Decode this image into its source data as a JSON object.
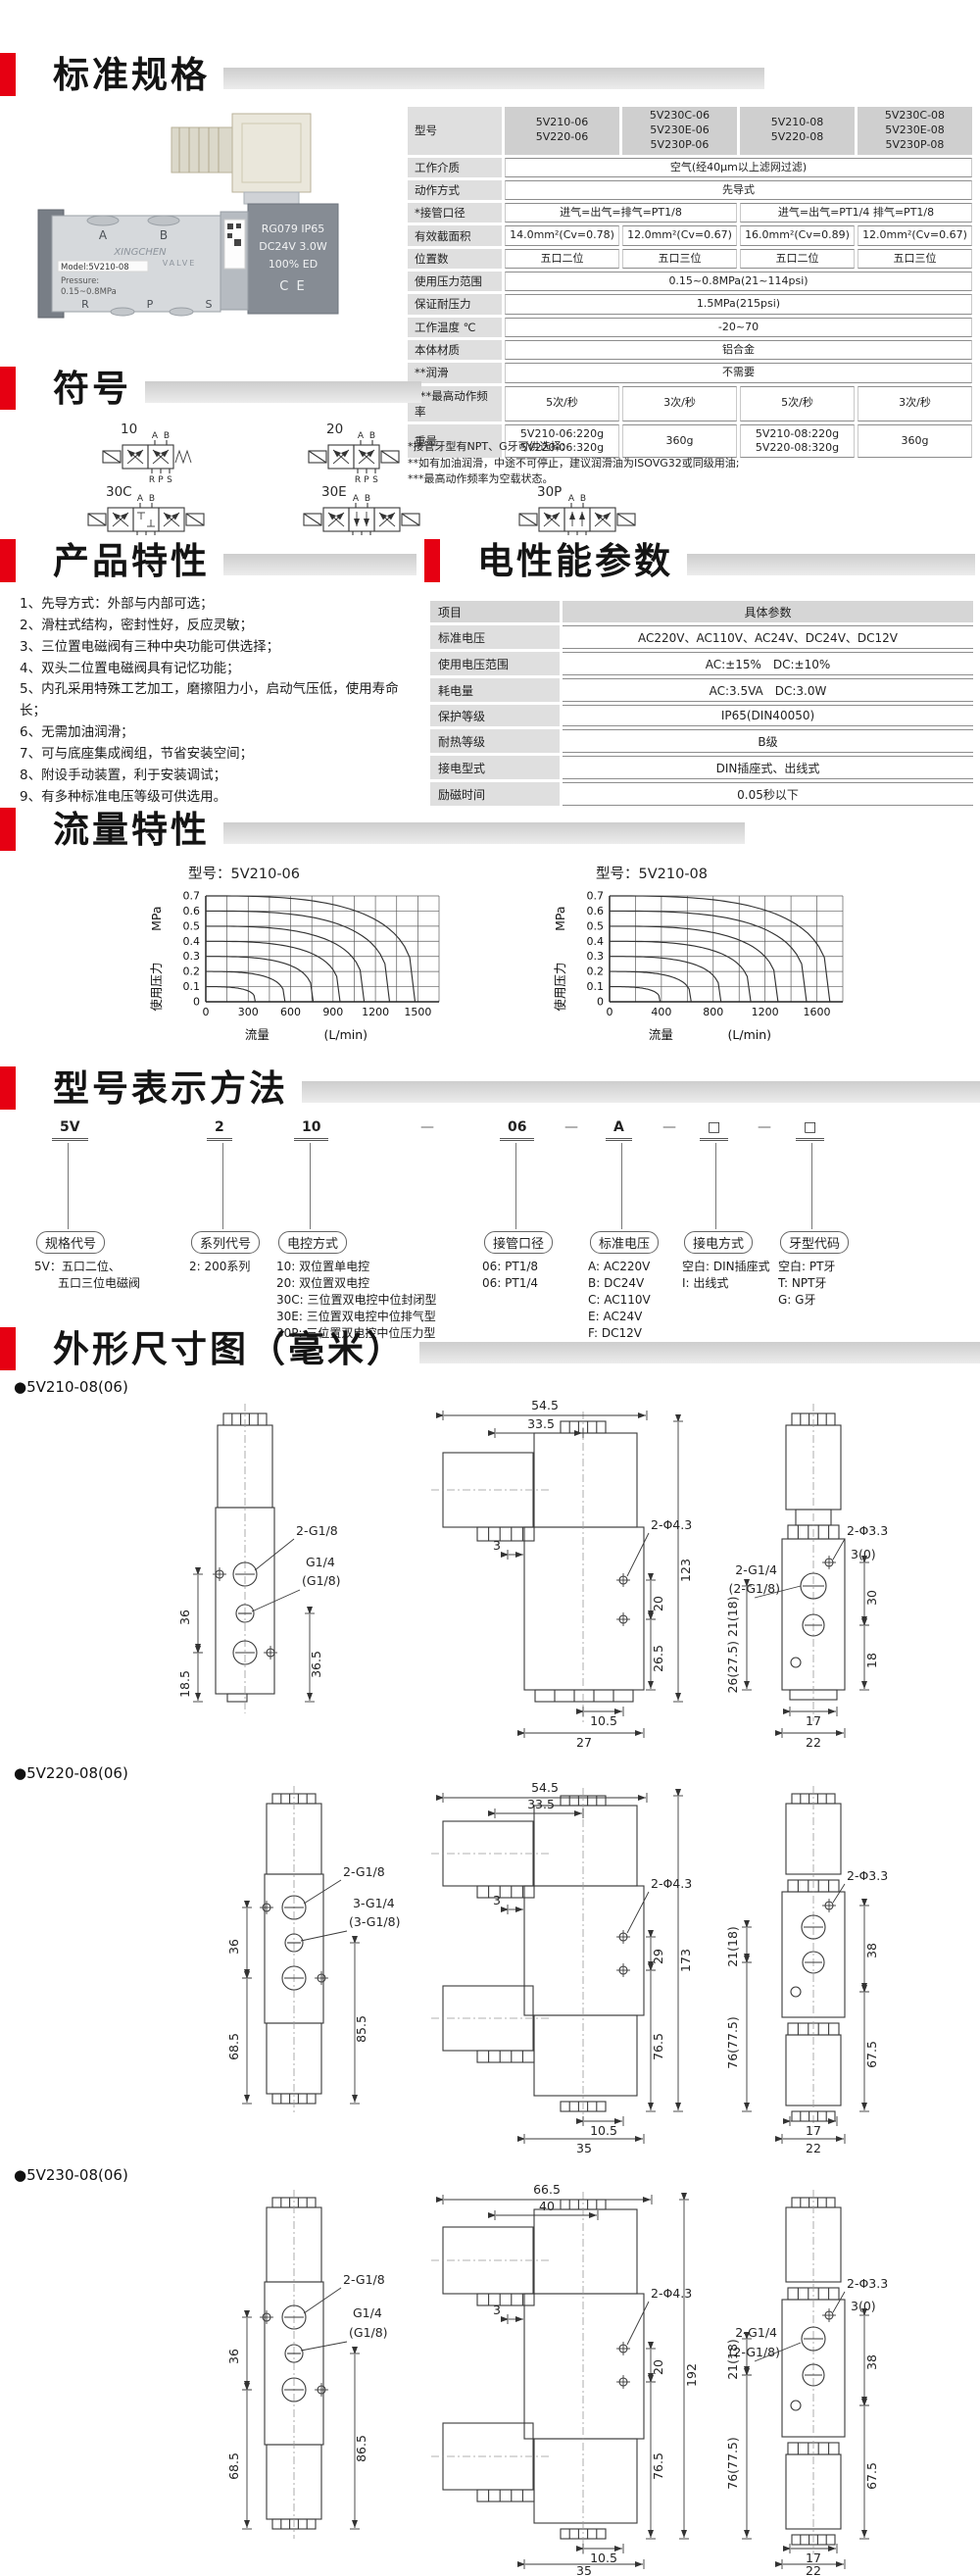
{
  "page": {
    "accent": "#e60012",
    "background": "#ffffff"
  },
  "sections": {
    "standard": {
      "title": "标准规格"
    },
    "symbols": {
      "title": "符号"
    },
    "features": {
      "title": "产品特性"
    },
    "electrical": {
      "title": "电性能参数"
    },
    "flow": {
      "title": "流量特性"
    },
    "model": {
      "title": "型号表示方法"
    },
    "dimensions": {
      "title": "外形尺寸图（毫米）"
    }
  },
  "photo": {
    "labels": {
      "port_a": "A",
      "port_b": "B",
      "port_r": "R",
      "port_p": "P",
      "port_s": "S",
      "brand": "XINGCHEN",
      "brand2": "VALVE",
      "model": "Model:5V210-08",
      "pressure1": "Pressure:",
      "pressure2": "0.15~0.8MPa",
      "coil1": "RG079 IP65",
      "coil2": "DC24V 3.0W",
      "coil3": "100%  ED",
      "coil4": "C E"
    }
  },
  "spec_table": {
    "header": {
      "label": "型号",
      "models": [
        "5V210-06\n5V220-06",
        "5V230C-06\n5V230E-06\n5V230P-06",
        "5V210-08\n5V220-08",
        "5V230C-08\n5V230E-08\n5V230P-08"
      ]
    },
    "rows": [
      {
        "label": "工作介质",
        "cells": [
          {
            "t": "空气(经40μm以上滤网过滤)",
            "s": 4
          }
        ]
      },
      {
        "label": "动作方式",
        "cells": [
          {
            "t": "先导式",
            "s": 4
          }
        ]
      },
      {
        "label": "*接管口径",
        "cells": [
          {
            "t": "进气=出气=排气=PT1/8",
            "s": 2
          },
          {
            "t": "进气=出气=PT1/4  排气=PT1/8",
            "s": 2
          }
        ]
      },
      {
        "label": "有效截面积",
        "cells": [
          {
            "t": "14.0mm²(Cv=0.78)",
            "s": 1
          },
          {
            "t": "12.0mm²(Cv=0.67)",
            "s": 1
          },
          {
            "t": "16.0mm²(Cv=0.89)",
            "s": 1
          },
          {
            "t": "12.0mm²(Cv=0.67)",
            "s": 1
          }
        ]
      },
      {
        "label": "位置数",
        "cells": [
          {
            "t": "五口二位",
            "s": 1
          },
          {
            "t": "五口三位",
            "s": 1
          },
          {
            "t": "五口二位",
            "s": 1
          },
          {
            "t": "五口三位",
            "s": 1
          }
        ]
      },
      {
        "label": "使用压力范围",
        "cells": [
          {
            "t": "0.15~0.8MPa(21~114psi)",
            "s": 4
          }
        ]
      },
      {
        "label": "保证耐压力",
        "cells": [
          {
            "t": "1.5MPa(215psi)",
            "s": 4
          }
        ]
      },
      {
        "label": "工作温度 ℃",
        "cells": [
          {
            "t": "-20~70",
            "s": 4
          }
        ]
      },
      {
        "label": "本体材质",
        "cells": [
          {
            "t": "铝合金",
            "s": 4
          }
        ]
      },
      {
        "label": "**润滑",
        "cells": [
          {
            "t": "不需要",
            "s": 4
          }
        ]
      },
      {
        "label": "***最高动作频率",
        "cells": [
          {
            "t": "5次/秒",
            "s": 1
          },
          {
            "t": "3次/秒",
            "s": 1
          },
          {
            "t": "5次/秒",
            "s": 1
          },
          {
            "t": "3次/秒",
            "s": 1
          }
        ]
      },
      {
        "label": "重量",
        "cells": [
          {
            "t": "5V210-06:220g\n5V220-06:320g",
            "s": 1
          },
          {
            "t": "360g",
            "s": 1
          },
          {
            "t": "5V210-08:220g\n5V220-08:320g",
            "s": 1
          },
          {
            "t": "360g",
            "s": 1
          }
        ]
      }
    ],
    "footnotes": [
      "*接管牙型有NPT、G牙可供选择;",
      "**如有加油润滑，中途不可停止，建议润滑油为ISOVG32或同级用油;",
      "***最高动作频率为空载状态。"
    ]
  },
  "symbols": {
    "top_ports": [
      "A",
      "B"
    ],
    "bottom_ports": [
      "R",
      "P",
      "S"
    ],
    "items": [
      {
        "code": "10",
        "positions": 2,
        "right_spring": true
      },
      {
        "code": "20",
        "positions": 2,
        "right_spring": false
      },
      {
        "code": "30C",
        "positions": 3,
        "center": "closed"
      },
      {
        "code": "30E",
        "positions": 3,
        "center": "exhaust"
      },
      {
        "code": "30P",
        "positions": 3,
        "center": "pressure"
      }
    ]
  },
  "features": {
    "items": [
      "1、先导方式：外部与内部可选；",
      "2、滑柱式结构，密封性好，反应灵敏；",
      "3、三位置电磁阀有三种中央功能可供选择；",
      "4、双头二位置电磁阀具有记忆功能；",
      "5、内孔采用特殊工艺加工，磨擦阻力小，启动气压低，使用寿命长；",
      "6、无需加油润滑；",
      "7、可与底座集成阀组，节省安装空间；",
      "8、附设手动装置，利于安装调试；",
      "9、有多种标准电压等级可供选用。"
    ]
  },
  "electrical_table": {
    "header": [
      "项目",
      "具体参数"
    ],
    "rows": [
      [
        "标准电压",
        "AC220V、AC110V、AC24V、DC24V、DC12V"
      ],
      [
        "使用电压范围",
        "AC:±15%　DC:±10%"
      ],
      [
        "耗电量",
        "AC:3.5VA　DC:3.0W"
      ],
      [
        "保护等级",
        "IP65(DIN40050)"
      ],
      [
        "耐热等级",
        "B级"
      ],
      [
        "接电型式",
        "DIN插座式、出线式"
      ],
      [
        "励磁时间",
        "0.05秒以下"
      ]
    ]
  },
  "chart_data": [
    {
      "type": "line",
      "title": "型号：5V210-06",
      "ylabel": "使用压力",
      "ylabel_unit": "MPa",
      "xlabel": "流量",
      "xlabel_unit": "(L/min)",
      "ylim": [
        0,
        0.7
      ],
      "yticks": [
        0,
        0.1,
        0.2,
        0.3,
        0.4,
        0.5,
        0.6,
        0.7
      ],
      "xlim": [
        0,
        1650
      ],
      "xticks": [
        0,
        300,
        600,
        900,
        1200,
        1500
      ],
      "minor_grid_x": 150,
      "grid": true,
      "legend": false,
      "series": [
        {
          "name": "0.7MPa",
          "start_pressure": 0.7,
          "max_flow": 1480
        },
        {
          "name": "0.6MPa",
          "start_pressure": 0.6,
          "max_flow": 1300
        },
        {
          "name": "0.5MPa",
          "start_pressure": 0.5,
          "max_flow": 1120
        },
        {
          "name": "0.4MPa",
          "start_pressure": 0.4,
          "max_flow": 950
        },
        {
          "name": "0.3MPa",
          "start_pressure": 0.3,
          "max_flow": 760
        },
        {
          "name": "0.2MPa",
          "start_pressure": 0.2,
          "max_flow": 560
        },
        {
          "name": "0.1MPa",
          "start_pressure": 0.1,
          "max_flow": 350
        }
      ]
    },
    {
      "type": "line",
      "title": "型号：5V210-08",
      "ylabel": "使用压力",
      "ylabel_unit": "MPa",
      "xlabel": "流量",
      "xlabel_unit": "(L/min)",
      "ylim": [
        0,
        0.7
      ],
      "yticks": [
        0,
        0.1,
        0.2,
        0.3,
        0.4,
        0.5,
        0.6,
        0.7
      ],
      "xlim": [
        0,
        1800
      ],
      "xticks": [
        0,
        400,
        800,
        1200,
        1600
      ],
      "minor_grid_x": 200,
      "grid": true,
      "legend": false,
      "series": [
        {
          "name": "0.7MPa",
          "start_pressure": 0.7,
          "max_flow": 1700
        },
        {
          "name": "0.6MPa",
          "start_pressure": 0.6,
          "max_flow": 1520
        },
        {
          "name": "0.5MPa",
          "start_pressure": 0.5,
          "max_flow": 1300
        },
        {
          "name": "0.4MPa",
          "start_pressure": 0.4,
          "max_flow": 1090
        },
        {
          "name": "0.3MPa",
          "start_pressure": 0.3,
          "max_flow": 860
        },
        {
          "name": "0.2MPa",
          "start_pressure": 0.2,
          "max_flow": 630
        },
        {
          "name": "0.1MPa",
          "start_pressure": 0.1,
          "max_flow": 390
        }
      ]
    }
  ],
  "model_designation": {
    "segments": [
      {
        "code": "5V",
        "x": 53,
        "box": "规格代号",
        "desc": "5V：五口二位、\n　　五口三位电磁阀"
      },
      {
        "code": "2",
        "x": 211,
        "box": "系列代号",
        "desc": "2: 200系列"
      },
      {
        "code": "10",
        "x": 300,
        "box": "电控方式",
        "desc": "10: 双位置单电控\n20: 双位置双电控\n30C: 三位置双电控中位封闭型\n30E: 三位置双电控中位排气型\n30P: 三位置双电控中位压力型"
      },
      {
        "code": "—",
        "x": 421,
        "sep": true
      },
      {
        "code": "06",
        "x": 510,
        "box": "接管口径",
        "desc": "06: PT1/8\n06: PT1/4"
      },
      {
        "code": "—",
        "x": 568,
        "sep": true
      },
      {
        "code": "A",
        "x": 618,
        "box": "标准电压",
        "desc": "A: AC220V\nB: DC24V\nC: AC110V\nE: AC24V\nF: DC12V"
      },
      {
        "code": "—",
        "x": 668,
        "sep": true
      },
      {
        "code": "□",
        "x": 714,
        "box": "接电方式",
        "desc": "空白: DIN插座式\nI: 出线式"
      },
      {
        "code": "—",
        "x": 765,
        "sep": true
      },
      {
        "code": "□",
        "x": 812,
        "box": "牙型代码",
        "desc": "空白: PT牙\nT: NPT牙\nG: G牙"
      }
    ]
  },
  "dimensions": {
    "d1": {
      "caption": "●5V210-08(06)",
      "labels": {
        "port_top": "2-G1/8",
        "port_mid_a": "G1/4",
        "port_mid_b": "(G1/8)",
        "v36": "36",
        "v185": "18.5",
        "v365": "36.5",
        "w545": "54.5",
        "w335": "33.5",
        "off3": "3",
        "holes": "2-Φ4.3",
        "h123": "123",
        "s20": "20",
        "s265": "26.5",
        "b105": "10.5",
        "b27": "27",
        "rholes": "2-Φ3.3",
        "r30t": "3(0)",
        "rport_a": "2-G1/4",
        "rport_b": "(2-G1/8)",
        "rv26": "26(27.5) 21(18)",
        "r30": "30",
        "r18": "18",
        "b17": "17",
        "b22": "22"
      }
    },
    "d2": {
      "caption": "●5V220-08(06)",
      "labels": {
        "port_top": "2-G1/8",
        "port_mid_a": "3-G1/4",
        "port_mid_b": "(3-G1/8)",
        "v36": "36",
        "v685": "68.5",
        "v855": "85.5",
        "w545": "54.5",
        "w335": "33.5",
        "off3": "3",
        "holes": "2-Φ4.3",
        "s29": "29",
        "h173": "173",
        "b105": "10.5",
        "s765": "76.5",
        "b35": "35",
        "rholes": "2-Φ3.3",
        "rv21": "21(18)",
        "r38": "38",
        "rv76": "76(77.5)",
        "r675": "67.5",
        "b17": "17",
        "b22": "22"
      }
    },
    "d3": {
      "caption": "●5V230-08(06)",
      "labels": {
        "port_top": "2-G1/8",
        "port_mid_a": "G1/4",
        "port_mid_b": "(G1/8)",
        "v36": "36",
        "v685": "68.5",
        "v865": "86.5",
        "w665": "66.5",
        "w40": "40",
        "off3": "3",
        "holes": "2-Φ4.3",
        "s20": "20",
        "h192": "192",
        "b105": "10.5",
        "s765": "76.5",
        "b35": "35",
        "rholes": "2-Φ3.3",
        "r30t": "3(0)",
        "rport_a": "2-G1/4",
        "rport_b": "(2-G1/8)",
        "rv21": "21(18)",
        "r38": "38",
        "rv76": "76(77.5)",
        "r675": "67.5",
        "b17": "17",
        "b22": "22"
      }
    }
  }
}
